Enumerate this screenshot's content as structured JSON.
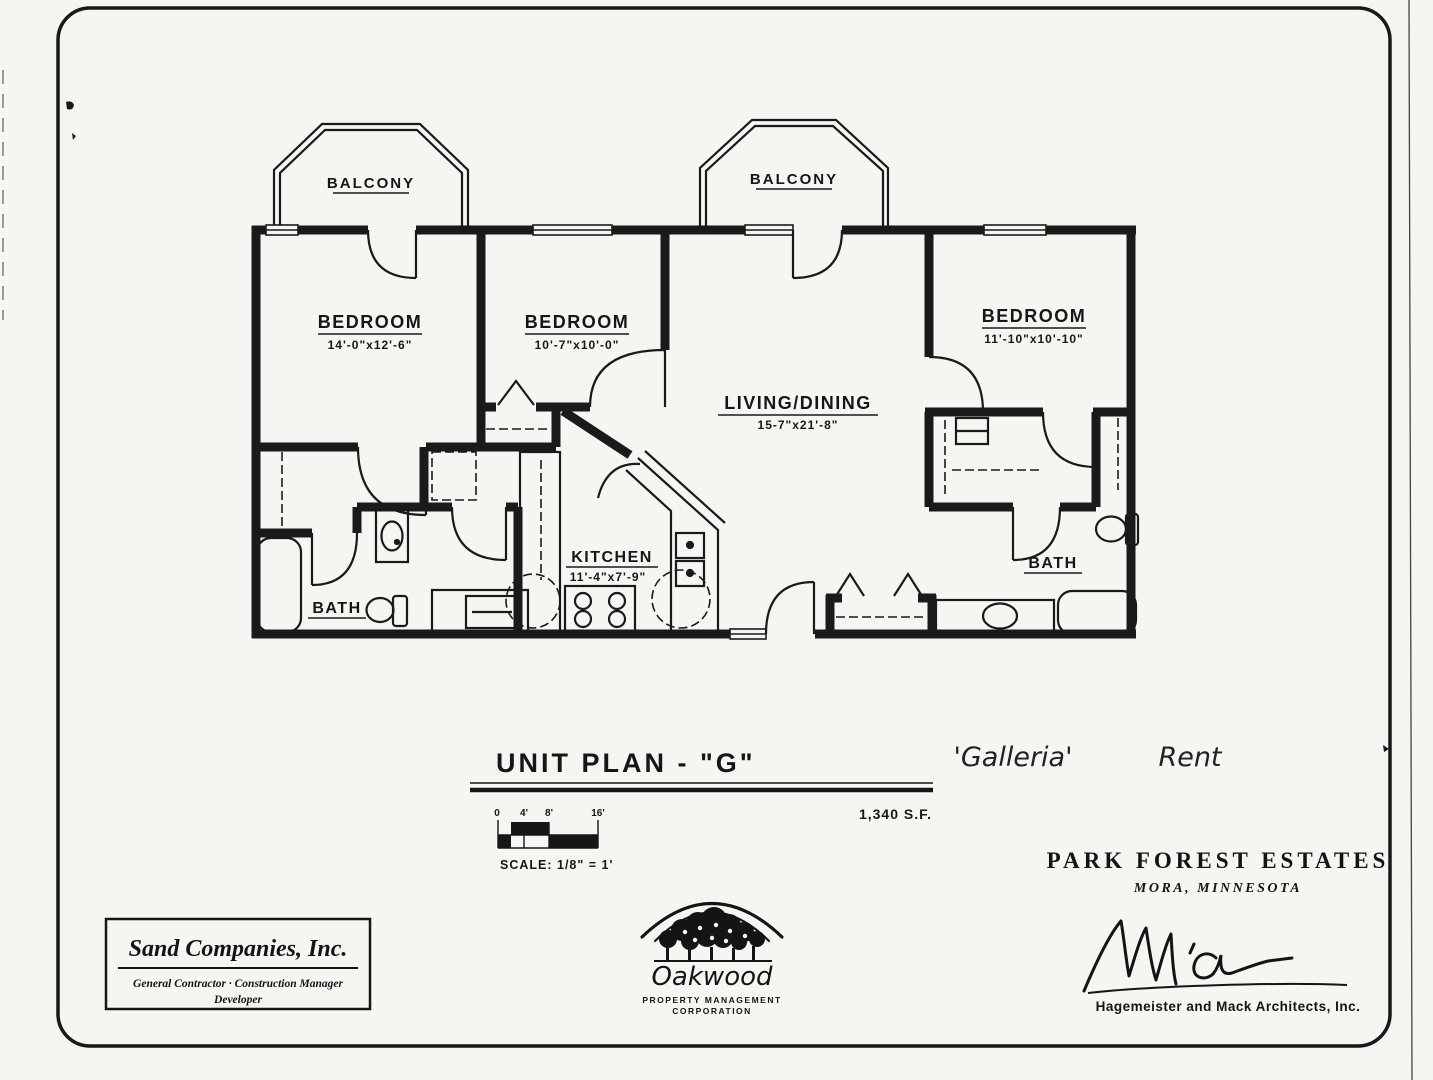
{
  "plan": {
    "balcony1": {
      "label": "BALCONY"
    },
    "balcony2": {
      "label": "BALCONY"
    },
    "bedroom1": {
      "label": "BEDROOM",
      "dims": "14'-0\"x12'-6\""
    },
    "bedroom2": {
      "label": "BEDROOM",
      "dims": "10'-7\"x10'-0\""
    },
    "bedroom3": {
      "label": "BEDROOM",
      "dims": "11'-10\"x10'-10\""
    },
    "living": {
      "label": "LIVING/DINING",
      "dims": "15-7\"x21'-8\""
    },
    "kitchen": {
      "label": "KITCHEN",
      "dims": "11'-4\"x7'-9\""
    },
    "bath1": {
      "label": "BATH"
    },
    "bath2": {
      "label": "BATH"
    }
  },
  "title_block": {
    "title": "UNIT PLAN - \"G\"",
    "area": "1,340 S.F.",
    "scale_label": "SCALE: 1/8\" = 1'",
    "ticks": {
      "t0": "0",
      "t1": "4'",
      "t2": "8'",
      "t3": "16'"
    },
    "handwritten_name": "'Galleria'",
    "handwritten_note": "Rent"
  },
  "contractor": {
    "name": "Sand Companies, Inc.",
    "line1": "General Contractor  ·  Construction Manager",
    "line2": "Developer"
  },
  "management": {
    "name": "Oakwood",
    "line1": "PROPERTY MANAGEMENT",
    "line2": "CORPORATION"
  },
  "project": {
    "name": "PARK FOREST ESTATES",
    "location": "MORA, MINNESOTA",
    "architect": "Hagemeister and Mack Architects, Inc."
  }
}
